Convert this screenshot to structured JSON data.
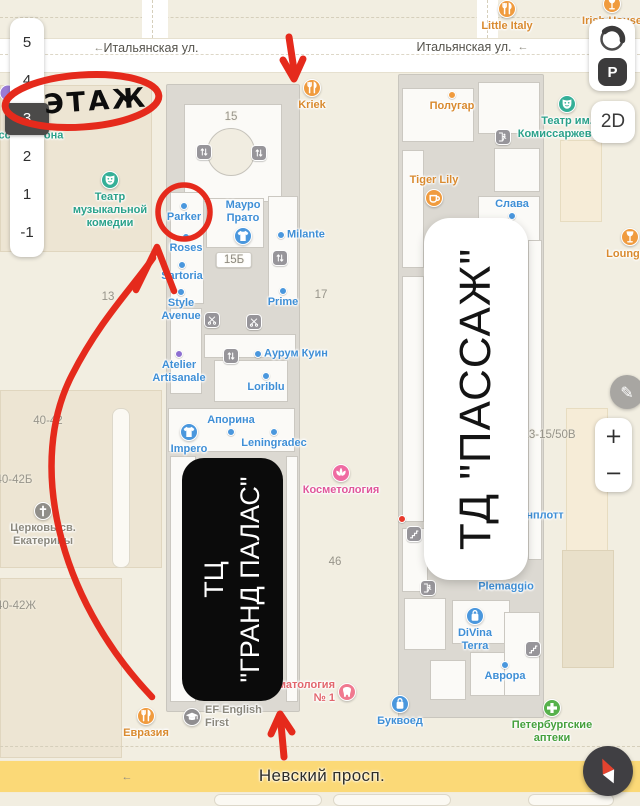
{
  "floor_selector": {
    "floors": [
      "5",
      "4",
      "3",
      "2",
      "1",
      "-1"
    ],
    "selected": "3"
  },
  "controls": {
    "parking": "P",
    "mode_2d": "2D",
    "zoom_in": "+",
    "zoom_out": "−",
    "pencil": "✎"
  },
  "streets": {
    "top_left": "Итальянская ул.",
    "top_right": "Итальянская ул.",
    "bottom": "Невский просп.",
    "arrow": "←"
  },
  "annotations": {
    "floor_note": "ЭТАЖ",
    "mall_left_line1": "ТЦ",
    "mall_left_line2": "\"ГРАНД ПАЛАС\"",
    "mall_right": "ТД \"ПАССАЖ\""
  },
  "colors": {
    "annotation_red": "#e52a1c",
    "road_yellow": "#fbd977",
    "label": {
      "orange": "#d98a2f",
      "blue": "#3f8fd6",
      "teal": "#2aa18a",
      "pink": "#e0569a",
      "dentist": "#e2666d",
      "green": "#44a03c",
      "gray": "#8b887d"
    }
  },
  "pois": [
    {
      "label": "Little Italy",
      "kind": "restaurant",
      "x": 507,
      "y": 9,
      "color": "orange"
    },
    {
      "label": "Irish House",
      "kind": "bar",
      "x": 612,
      "y": 4,
      "color": "orange"
    },
    {
      "label": "Kriek",
      "kind": "restaurant",
      "x": 312,
      "y": 88,
      "color": "orange"
    },
    {
      "label": "Полугар",
      "kind": "dot-orange",
      "x": 452,
      "y": 95,
      "layout": "dot-top",
      "color": "orange"
    },
    {
      "label": "Tiger Lily",
      "kind": "coffee",
      "x": 434,
      "y": 198,
      "layout": "label-top",
      "color": "orange"
    },
    {
      "label": "LoungeR",
      "kind": "bar",
      "x": 630,
      "y": 237,
      "color": "orange"
    },
    {
      "label": "Театр им.\nКомиссаржевской",
      "kind": "theater",
      "x": 567,
      "y": 104,
      "color": "teal"
    },
    {
      "label": "Театр\nмузыкальной\nкомедии",
      "kind": "theater",
      "x": 110,
      "y": 180,
      "color": "teal"
    },
    {
      "label": "Слава",
      "kind": "dot",
      "x": 512,
      "y": 216,
      "layout": "label-top",
      "color": "blue"
    },
    {
      "label": "Parker",
      "kind": "dot",
      "x": 184,
      "y": 206,
      "layout": "dot-top",
      "color": "blue"
    },
    {
      "label": "Roses",
      "kind": "dot",
      "x": 186,
      "y": 237,
      "layout": "dot-top",
      "color": "blue"
    },
    {
      "label": "Sartoria",
      "kind": "dot",
      "x": 182,
      "y": 265,
      "layout": "dot-top",
      "color": "blue"
    },
    {
      "label": "Style\nAvenue",
      "kind": "dot",
      "x": 181,
      "y": 292,
      "layout": "dot-top",
      "color": "blue"
    },
    {
      "label": "Мауро\nПрато",
      "kind": "clothing",
      "x": 243,
      "y": 236,
      "layout": "label-top",
      "color": "blue"
    },
    {
      "label": "Milante",
      "kind": "dot",
      "x": 281,
      "y": 235,
      "layout": "dot-left",
      "color": "blue"
    },
    {
      "label": "Prime",
      "kind": "dot",
      "x": 283,
      "y": 291,
      "layout": "dot-top",
      "color": "blue"
    },
    {
      "label": "Аурум Куин",
      "kind": "dot",
      "x": 258,
      "y": 354,
      "layout": "dot-left",
      "color": "blue"
    },
    {
      "label": "Atelier\nArtisanale",
      "kind": "dot-purple",
      "x": 179,
      "y": 354,
      "layout": "dot-top",
      "color": "blue"
    },
    {
      "label": "Loriblu",
      "kind": "dot",
      "x": 266,
      "y": 376,
      "layout": "dot-top",
      "color": "blue"
    },
    {
      "label": "Апорина",
      "kind": "dot",
      "x": 231,
      "y": 432,
      "layout": "label-top",
      "color": "blue"
    },
    {
      "label": "Leningradec",
      "kind": "dot",
      "x": 274,
      "y": 432,
      "layout": "dot-top",
      "color": "blue"
    },
    {
      "label": "Impero",
      "kind": "clothing",
      "x": 189,
      "y": 432,
      "color": "blue"
    },
    {
      "label": "Косметология",
      "kind": "cosmetics",
      "x": 341,
      "y": 473,
      "color": "pink"
    },
    {
      "label": "Церковь св.\nЕкатерины",
      "kind": "church",
      "x": 43,
      "y": 511,
      "color": "gray"
    },
    {
      "label": "Plemaggio",
      "kind": "none",
      "x": 506,
      "y": 587,
      "layout": "label-only",
      "color": "blue"
    },
    {
      "label": "нплотт",
      "kind": "none",
      "x": 545,
      "y": 516,
      "layout": "label-only",
      "color": "blue"
    },
    {
      "label": "DiVina\nTerra",
      "kind": "bag",
      "x": 475,
      "y": 616,
      "color": "blue"
    },
    {
      "label": "Аврора",
      "kind": "dot",
      "x": 505,
      "y": 665,
      "layout": "dot-top",
      "color": "blue"
    },
    {
      "label": "Евразия",
      "kind": "restaurant",
      "x": 146,
      "y": 716,
      "color": "orange"
    },
    {
      "label": "EF English\nFirst",
      "kind": "education",
      "x": 192,
      "y": 717,
      "layout": "label-right",
      "color": "gray"
    },
    {
      "label": "Стоматология\n№ 1",
      "kind": "dentist",
      "x": 347,
      "y": 692,
      "layout": "label-left",
      "color": "dentist"
    },
    {
      "label": "Буквоед",
      "kind": "bag",
      "x": 400,
      "y": 704,
      "color": "blue"
    },
    {
      "label": "Петербургские\nаптеки",
      "kind": "pharmacy",
      "x": 552,
      "y": 708,
      "color": "green"
    },
    {
      "label": "усская икона",
      "kind": "none",
      "x": 28,
      "y": 136,
      "layout": "label-only",
      "color": "teal"
    },
    {
      "label": "",
      "kind": "dot-red",
      "x": 402,
      "y": 519,
      "layout": "marker-only"
    },
    {
      "label": "",
      "kind": "dot-purple-big",
      "x": 8,
      "y": 93,
      "layout": "marker-only"
    }
  ],
  "house_numbers": [
    {
      "text": "15",
      "x": 231,
      "y": 117
    },
    {
      "text": "15Б",
      "x": 234,
      "y": 260,
      "plate": true
    },
    {
      "text": "17",
      "x": 321,
      "y": 295
    },
    {
      "text": "13",
      "x": 108,
      "y": 297
    },
    {
      "text": "46",
      "x": 335,
      "y": 562
    },
    {
      "text": "40-42",
      "x": 48,
      "y": 421
    },
    {
      "text": "40-42Б",
      "x": 14,
      "y": 480
    },
    {
      "text": "40-42Ж",
      "x": 16,
      "y": 606
    },
    {
      "text": "13-15/50В",
      "x": 549,
      "y": 435
    }
  ],
  "utility_icons": [
    {
      "kind": "elevator",
      "x": 204,
      "y": 152
    },
    {
      "kind": "elevator",
      "x": 259,
      "y": 153
    },
    {
      "kind": "elevator",
      "x": 280,
      "y": 258
    },
    {
      "kind": "elevator",
      "x": 231,
      "y": 356
    },
    {
      "kind": "scissors",
      "x": 212,
      "y": 320
    },
    {
      "kind": "scissors",
      "x": 254,
      "y": 322
    },
    {
      "kind": "stairs",
      "x": 414,
      "y": 534
    },
    {
      "kind": "stairs",
      "x": 533,
      "y": 649
    },
    {
      "kind": "exit",
      "x": 503,
      "y": 137
    },
    {
      "kind": "exit",
      "x": 428,
      "y": 588
    }
  ]
}
